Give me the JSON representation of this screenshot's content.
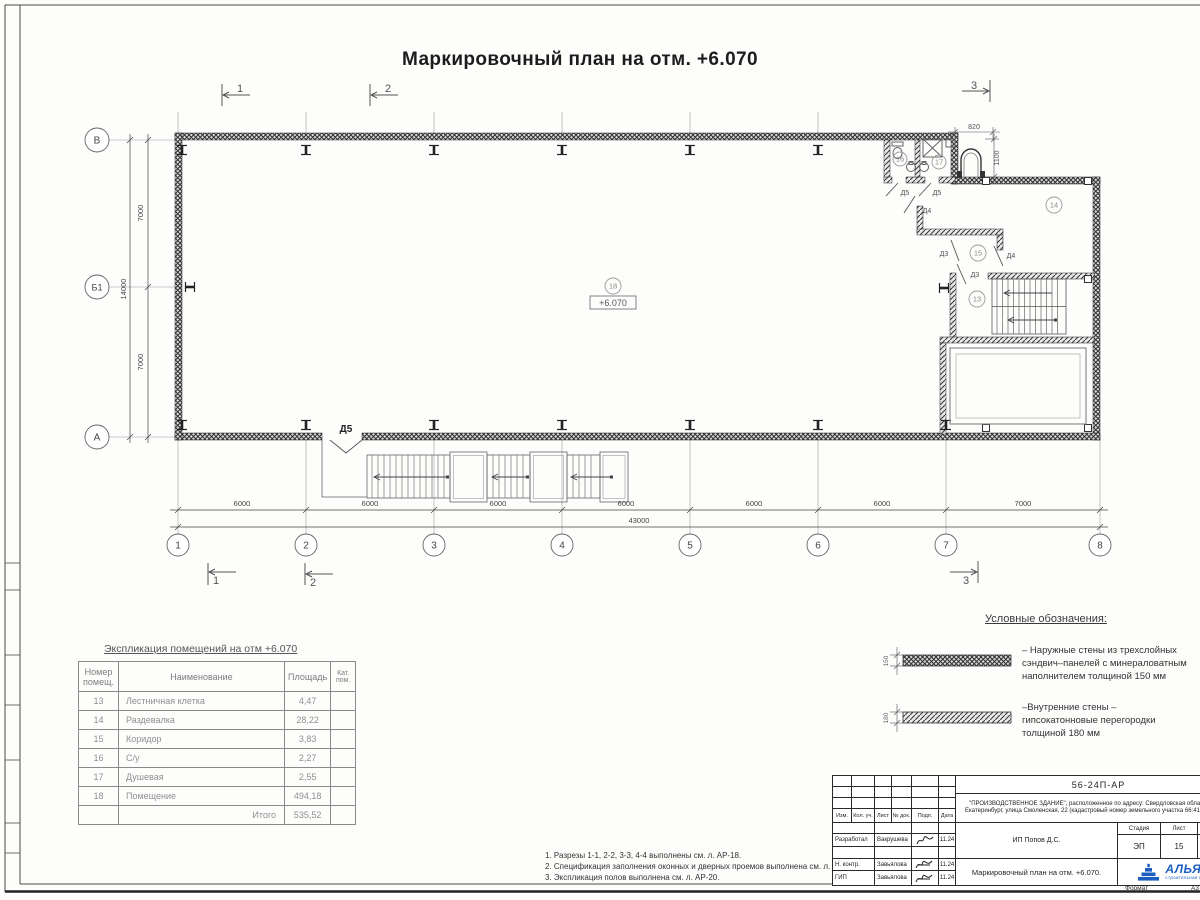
{
  "sheet": {
    "title": "Маркировочный план на отм. +6.070"
  },
  "plan": {
    "elevation": "+6.070",
    "axes_bottom": [
      "1",
      "2",
      "3",
      "4",
      "5",
      "6",
      "7",
      "8"
    ],
    "axes_left": [
      "В",
      "Б1",
      "А"
    ],
    "dims_bottom": [
      "6000",
      "6000",
      "6000",
      "6000",
      "6000",
      "6000",
      "7000"
    ],
    "dim_total_bottom": "43000",
    "dims_left": [
      "7000",
      "7000"
    ],
    "dim_total_left": "14000",
    "dim_opening_width": "820",
    "dim_opening_height": "1100",
    "sections": [
      "1",
      "2",
      "3"
    ],
    "rooms": [
      "13",
      "14",
      "15",
      "16",
      "17",
      "18"
    ],
    "doors": [
      "Д5",
      "Д5",
      "Д4",
      "Д3",
      "Д4",
      "Д3",
      "Д5"
    ]
  },
  "explication": {
    "title": "Экспликация помещений на отм +6.070",
    "col_num": "Номер помещ.",
    "col_name": "Наименование",
    "col_area": "Площадь",
    "col_cat": "Кат. пом.",
    "rows": [
      {
        "num": "13",
        "name": "Лестничная клетка",
        "area": "4,47"
      },
      {
        "num": "14",
        "name": "Раздевалка",
        "area": "28,22"
      },
      {
        "num": "15",
        "name": "Коридор",
        "area": "3,83"
      },
      {
        "num": "16",
        "name": "С/у",
        "area": "2,27"
      },
      {
        "num": "17",
        "name": "Душевая",
        "area": "2,55"
      },
      {
        "num": "18",
        "name": "Помещение",
        "area": "494,18"
      }
    ],
    "total_label": "Итого",
    "total_area": "535,52"
  },
  "legend": {
    "title": "Условные обозначения:",
    "items": [
      {
        "thickness": "150",
        "text": "– Наружные стены из трехслойных сэндвич–панелей с минераловатным наполнителем толщиной 150 мм"
      },
      {
        "thickness": "180",
        "text": "–Внутренние стены – гипсокатонновые перегородки толщиной 180 мм"
      }
    ]
  },
  "notes": [
    "1. Разрезы 1-1, 2-2, 3-3, 4-4 выполнены см. л. АР-18.",
    "2. Спецификация заполнения оконных и дверных проемов выполнена см. л. АР-20.",
    "3. Экспликация полов выполнена см. л. АР-20."
  ],
  "stamp": {
    "doc_number": "56-24П-АР",
    "description": "\"ПРОИЗВОДСТВЕННОЕ ЗДАНИЕ\", расположенное по адресу: Свердловская область, город Екатеринбург, улица Смоленская, 22 (кадастровый номер земельного участка 66:41:0506029:3)",
    "cols": [
      "Изм.",
      "Кол. уч.",
      "Лист",
      "№ док.",
      "Подп.",
      "Дата"
    ],
    "sign_rows": [
      {
        "role": "Разработал",
        "name": "Вакрушева",
        "date": "11.24"
      },
      {
        "role": "Н. контр.",
        "name": "Завьялова",
        "date": "11.24"
      },
      {
        "role": "ГИП",
        "name": "Завьялова",
        "date": "11.24"
      }
    ],
    "client": "ИП Попов Д.С.",
    "stage_label": "Стадия",
    "sheet_label": "Лист",
    "sheets_label": "Листов",
    "stage": "ЭП",
    "sheet_num": "15",
    "sheets_total": "2",
    "sheet_title": "Маркировочный план на отм. +6.070.",
    "company": "АЛЬЯНС",
    "company_sub": "строительная компания",
    "format_label": "Формат",
    "format_value": "А3"
  }
}
